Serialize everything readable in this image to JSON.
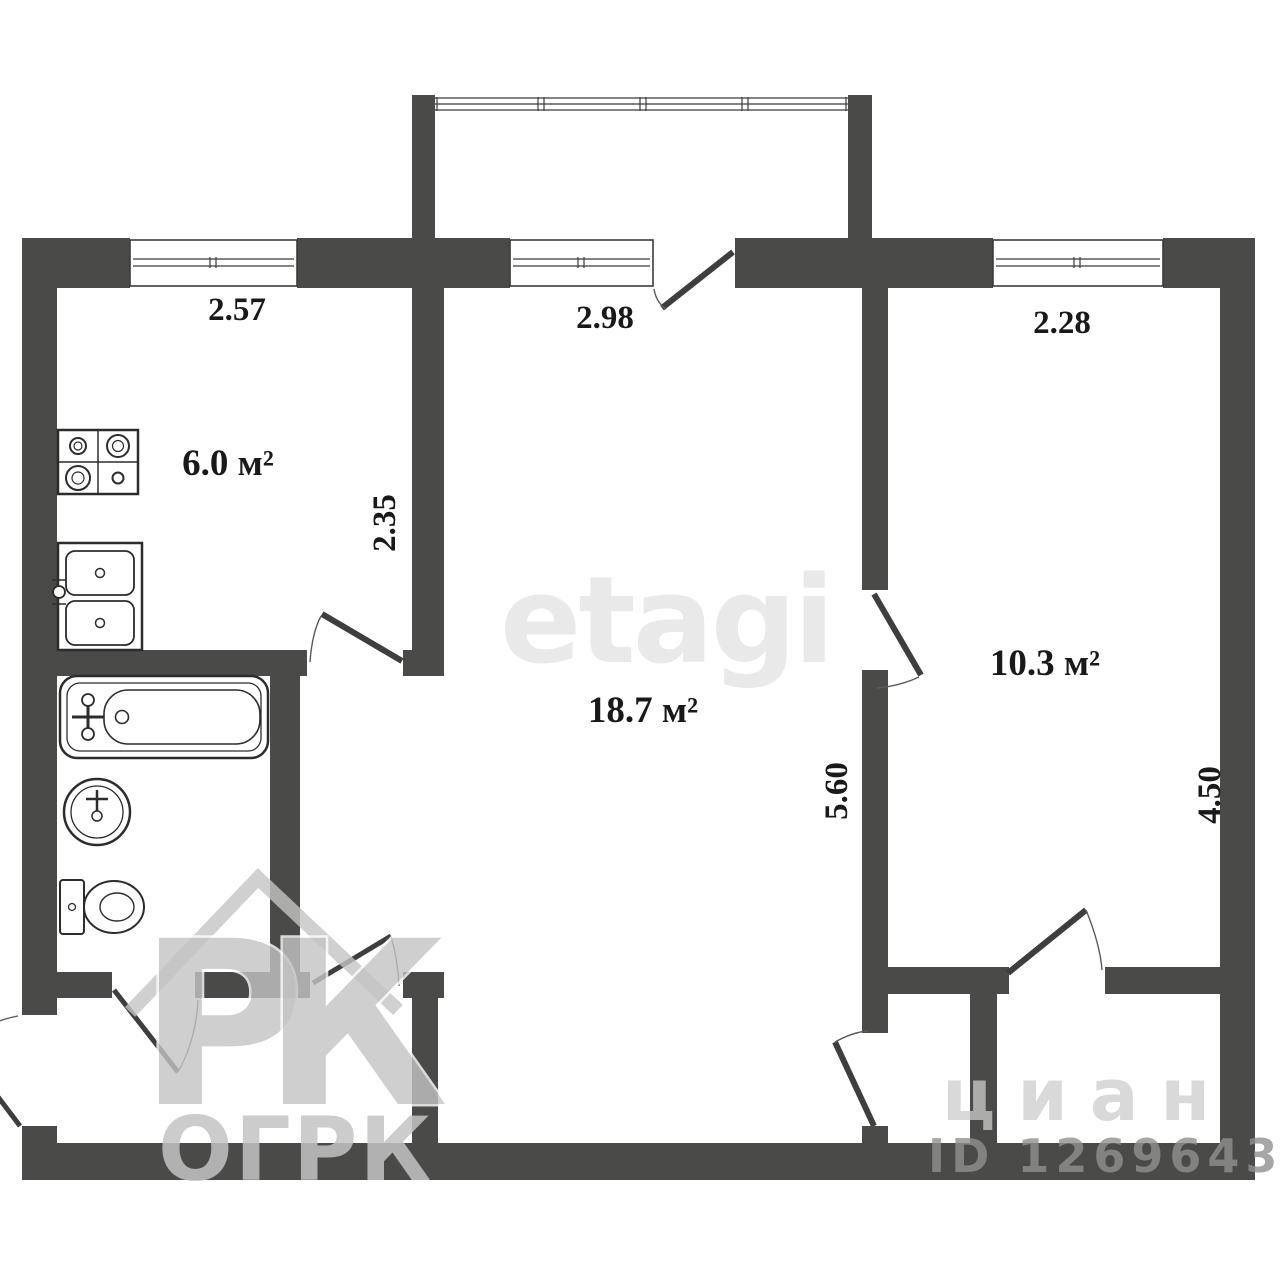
{
  "page": {
    "background": "#ffffff"
  },
  "floorplan": {
    "type": "apartment floor plan, 2 rooms",
    "rooms": [
      {
        "name": "kitchen",
        "area": "6.0 м²"
      },
      {
        "name": "living-room",
        "area": "18.7 м²"
      },
      {
        "name": "room",
        "area": "10.3 м²"
      }
    ],
    "labels": {
      "kitchen_width": "2.57",
      "kitchen_depth": "2.35",
      "living_width": "2.98",
      "living_height": "5.60",
      "room_width": "2.28",
      "room_height": "4.50"
    },
    "watermarks": {
      "etagi": "etagi",
      "ogrk_p": "Р",
      "ogrk_k": "К",
      "ogrk": "ОГРК",
      "cian": "циан",
      "listing_id": "ID 12696433"
    },
    "colors": {
      "wall": "#4a4a48",
      "line": "#2c2c2c",
      "label_text": "#191919",
      "watermark_light": "#e9e9e9",
      "watermark_gray": "#c4c4c4"
    },
    "fixtures": [
      "stove",
      "kitchen-sink",
      "bathtub",
      "washbasin",
      "toilet"
    ],
    "windows": [
      "kitchen-window",
      "balcony-glazing",
      "balcony-window",
      "room-window"
    ],
    "doors": [
      "entrance-door",
      "bathroom-door",
      "hall-door",
      "kitchen-door",
      "balcony-door",
      "room-door",
      "closet-door",
      "living-room-closet-door"
    ]
  }
}
